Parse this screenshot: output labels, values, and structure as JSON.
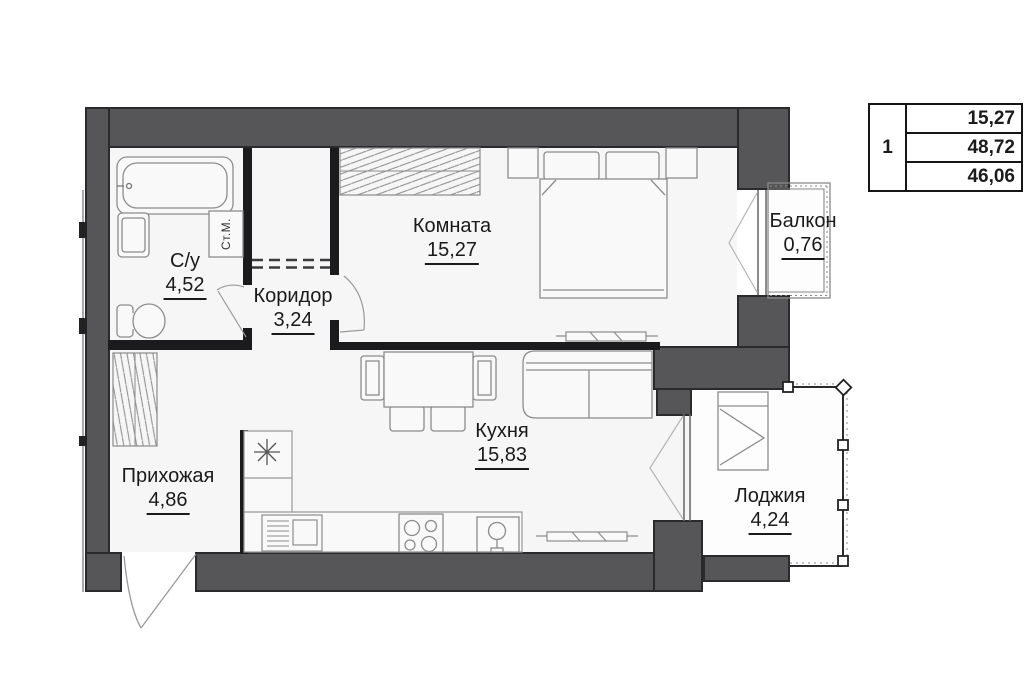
{
  "info_table": {
    "unit_number": "1",
    "rows": [
      "15,27",
      "48,72",
      "46,06"
    ]
  },
  "rooms": {
    "room": {
      "label": "Комната",
      "area": "15,27"
    },
    "bathroom": {
      "label": "С/у",
      "area": "4,52"
    },
    "corridor": {
      "label": "Коридор",
      "area": "3,24"
    },
    "hallway": {
      "label": "Прихожая",
      "area": "4,86"
    },
    "kitchen": {
      "label": "Кухня",
      "area": "15,83"
    },
    "balcony": {
      "label": "Балкон",
      "area": "0,76"
    },
    "loggia": {
      "label": "Лоджия",
      "area": "4,24"
    }
  },
  "annotations": {
    "washing_machine": "Ст.М."
  },
  "colors": {
    "wall": "#565659",
    "partition": "#1b1b1d",
    "floor": "#f6f6f7",
    "furniture_line": "#8c8c8c",
    "text": "#1a1a1a"
  }
}
